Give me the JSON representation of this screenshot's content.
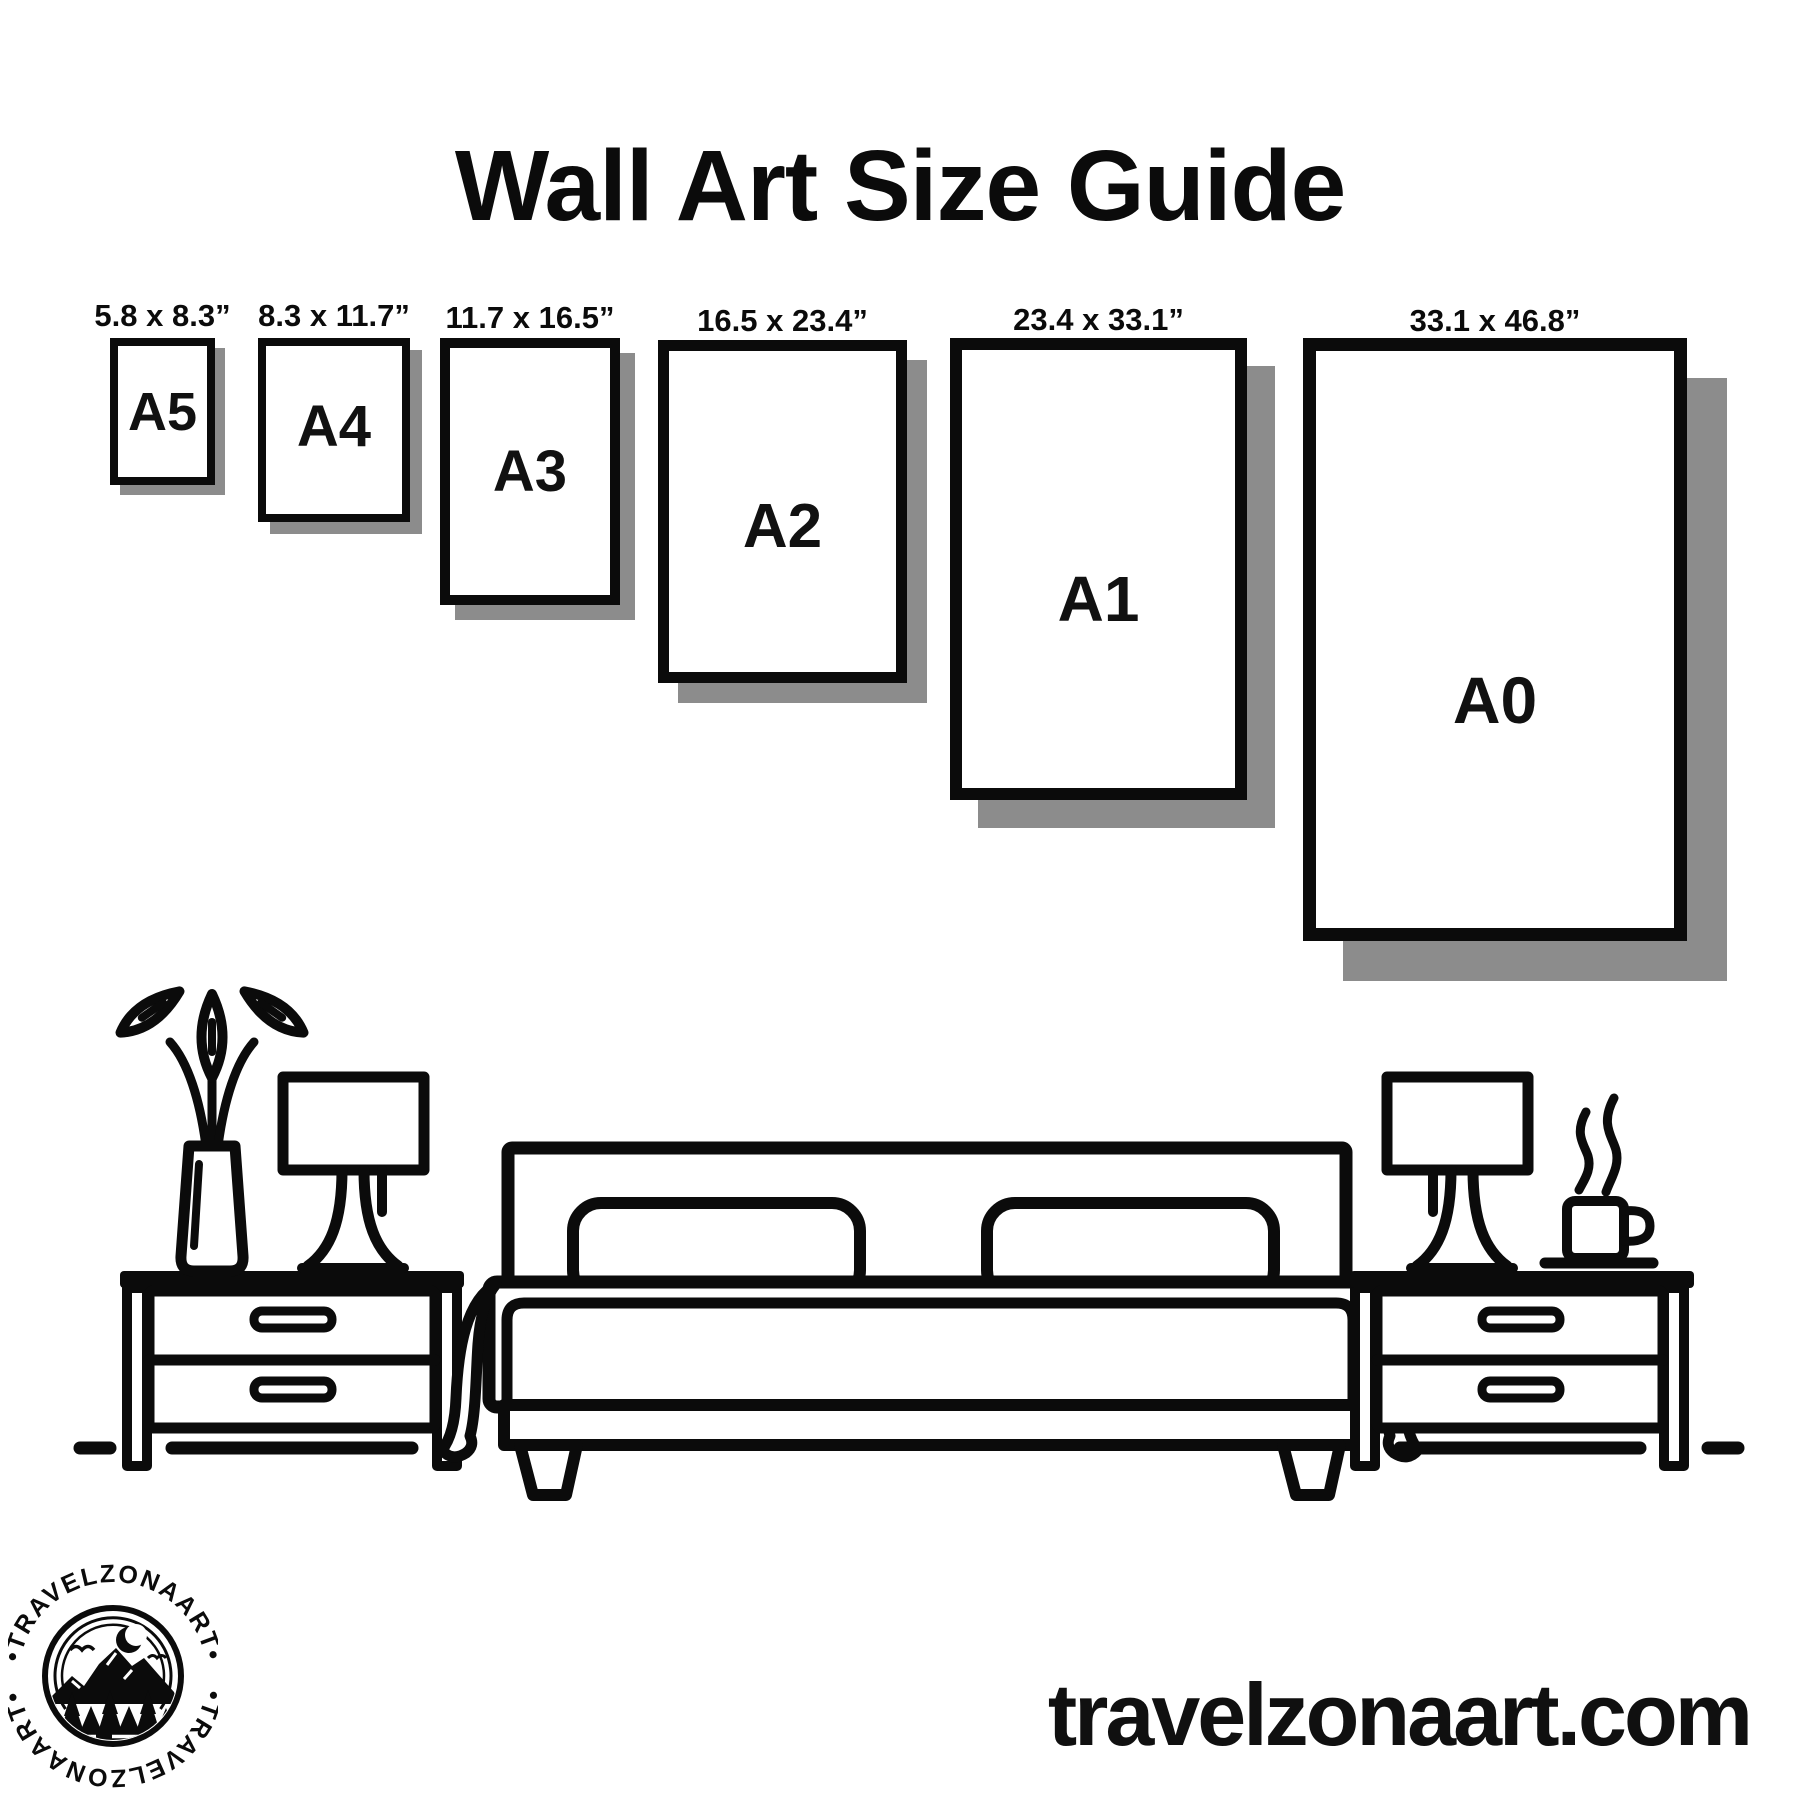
{
  "title": "Wall Art Size Guide",
  "frames": [
    {
      "name": "A5",
      "size_label": "5.8 x 8.3”"
    },
    {
      "name": "A4",
      "size_label": "8.3 x 11.7”"
    },
    {
      "name": "A3",
      "size_label": "11.7 x 16.5”"
    },
    {
      "name": "A2",
      "size_label": "16.5 x 23.4”"
    },
    {
      "name": "A1",
      "size_label": "23.4 x 33.1”"
    },
    {
      "name": "A0",
      "size_label": "33.1 x 46.8”"
    }
  ],
  "scene": {
    "items": [
      {
        "icon": "flower-vase-icon"
      },
      {
        "icon": "table-lamp-icon"
      },
      {
        "icon": "nightstand-icon"
      },
      {
        "icon": "double-bed-icon"
      },
      {
        "icon": "table-lamp-icon"
      },
      {
        "icon": "coffee-mug-icon"
      },
      {
        "icon": "nightstand-icon"
      },
      {
        "icon": "floor-line-icon"
      }
    ]
  },
  "logo": {
    "arc_text_top": "•TRAVELZONAART•",
    "arc_text_bottom": "•TRAVELZONAART•"
  },
  "website": "travelzonaart.com",
  "colors": {
    "ink": "#0b0b0b",
    "paper": "#ffffff",
    "shadow": "#8c8c8c"
  }
}
